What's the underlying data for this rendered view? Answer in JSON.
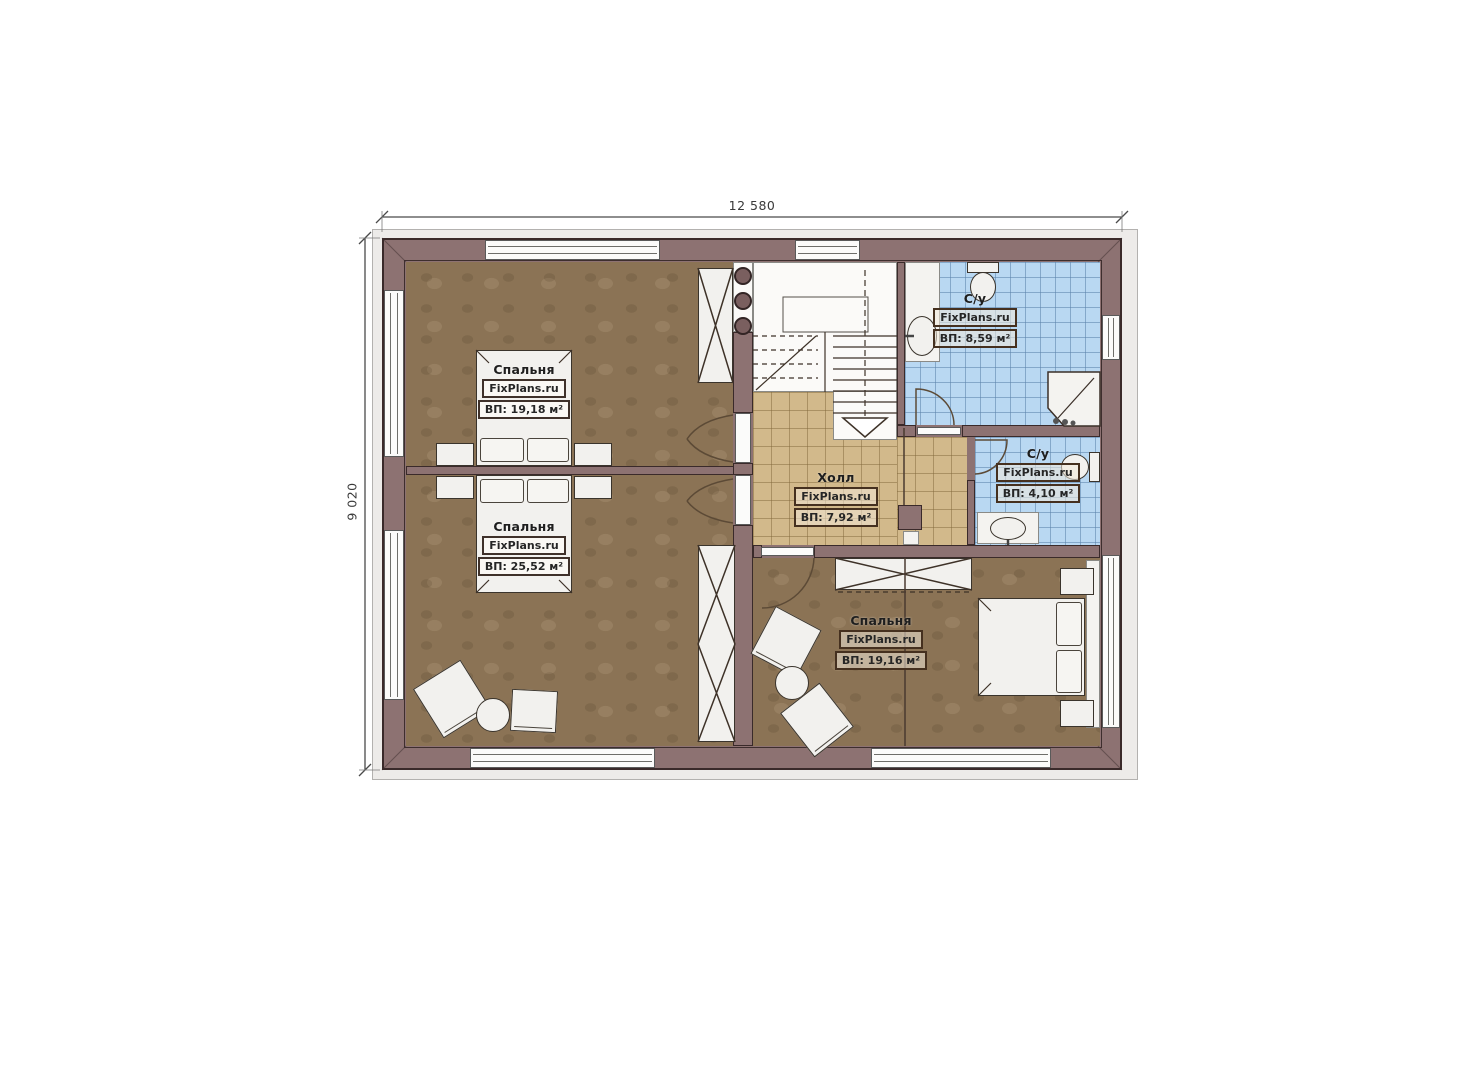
{
  "plan_title": "Floor plan (second storey)",
  "dimensions": {
    "width_label": "12 580",
    "height_label": "9 020"
  },
  "rooms": [
    {
      "id": "bedroom-top-left",
      "name": "Спальня",
      "brand": "FixPlans.ru",
      "area": "ВП: 19,18 м²"
    },
    {
      "id": "bedroom-bottom-left",
      "name": "Спальня",
      "brand": "FixPlans.ru",
      "area": "ВП: 25,52 м²"
    },
    {
      "id": "hall",
      "name": "Холл",
      "brand": "FixPlans.ru",
      "area": "ВП: 7,92 м²"
    },
    {
      "id": "bathroom-large",
      "name": "С/у",
      "brand": "FixPlans.ru",
      "area": "ВП: 8,59 м²"
    },
    {
      "id": "bathroom-small",
      "name": "С/у",
      "brand": "FixPlans.ru",
      "area": "ВП: 4,10 м²"
    },
    {
      "id": "bedroom-right",
      "name": "Спальня",
      "brand": "FixPlans.ru",
      "area": "ВП: 19,16 м²"
    }
  ],
  "colors": {
    "wall": "#8d7272",
    "wall_outline": "#3a2a2a",
    "bedroom_floor": "#8b7355",
    "hall_tile": "#d2b98b",
    "bathroom_tile": "#b9d8f2",
    "furniture": "#f2f1ee"
  }
}
